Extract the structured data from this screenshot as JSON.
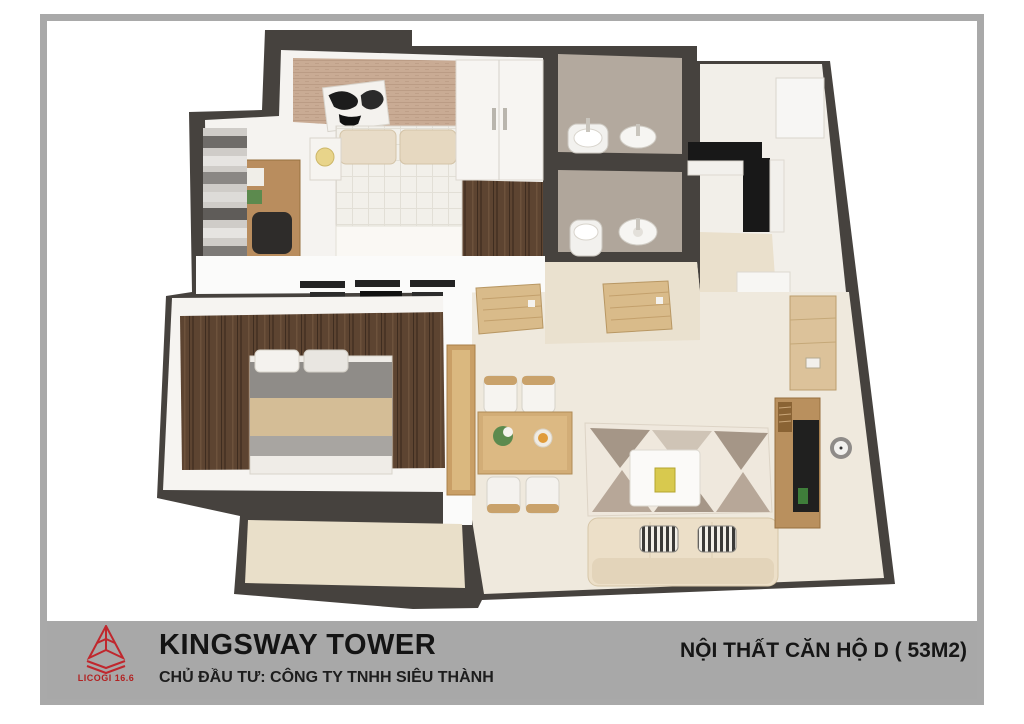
{
  "footer": {
    "title": "KINGSWAY TOWER",
    "subtitle": "CHỦ ĐẦU TƯ: CÔNG TY TNHH SIÊU THÀNH",
    "right_label": "NỘI THẤT CĂN HỘ D ( 53M2)",
    "logo_text": "LICOGI 16.6",
    "band_color": "#a8a8a8",
    "text_color": "#141414",
    "logo_color": "#c0272d"
  },
  "frame": {
    "border_color": "#a9a9a9",
    "background": "#ffffff"
  },
  "floorplan_colors": {
    "wall": "#46423e",
    "white_wall": "#fbfbfa",
    "wood_floor": "#5d4431",
    "bathroom_tile": "#b3a99e",
    "hall_floor": "#eae1cf",
    "living_floor": "#efe9dd",
    "balcony_floor": "#e9dfc9",
    "wallpaper": "#c9ab94",
    "furniture_wood": "#c9a26b",
    "door_wood": "#d9bb8a",
    "sofa": "#ecdfc8",
    "counter": "#181818"
  }
}
